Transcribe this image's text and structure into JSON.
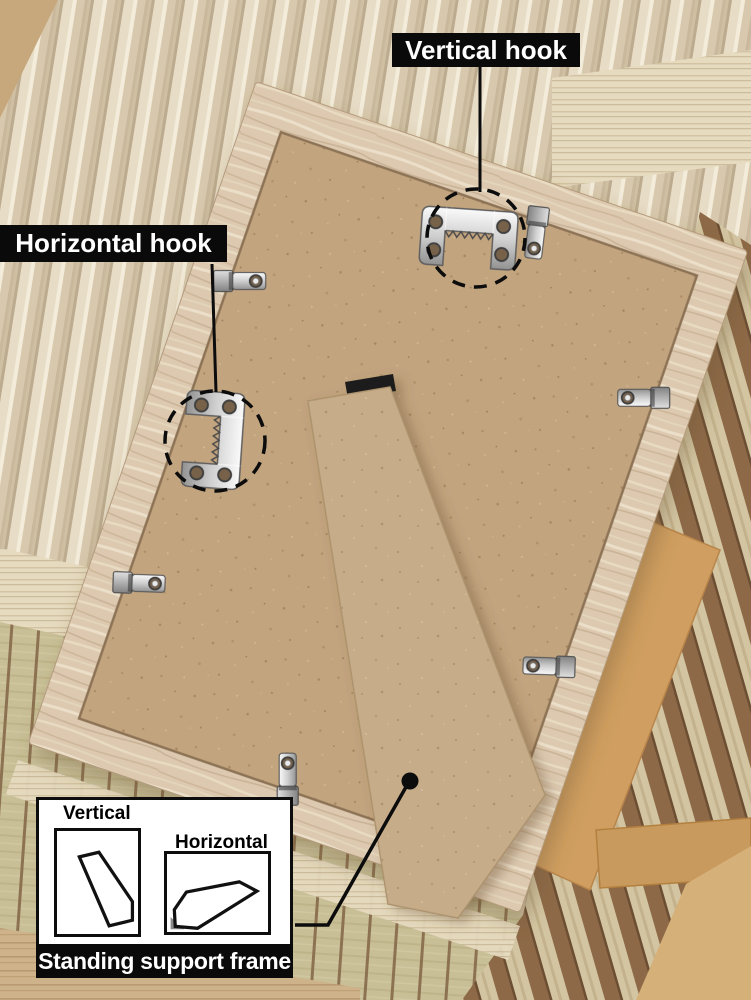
{
  "annotations": {
    "vertical_hook_label": "Vertical hook",
    "horizontal_hook_label": "Horizontal hook"
  },
  "inset": {
    "vertical_label": "Vertical",
    "horizontal_label": "Horizontal",
    "title": "Standing support frame"
  },
  "colors": {
    "annotation_bg": "#0a0a0a",
    "annotation_text": "#ffffff",
    "frame_wood": "#dcc9b0",
    "backboard_mdf": "#c2a47f",
    "stand_leg": "#c9ad8a",
    "metal_hardware": "#d6d6d6",
    "ribbed_glass": "#e2d6bf",
    "tatami_mat": "#c7be96",
    "wood_slats": "#8d6947"
  },
  "icons": {
    "vertical_hook": "sawtooth-hanger-icon",
    "horizontal_hook": "sawtooth-hanger-icon",
    "frame_clip": "metal-clip-icon",
    "leader_dot": "annotation-dot-icon",
    "hook_highlight": "dashed-circle"
  }
}
